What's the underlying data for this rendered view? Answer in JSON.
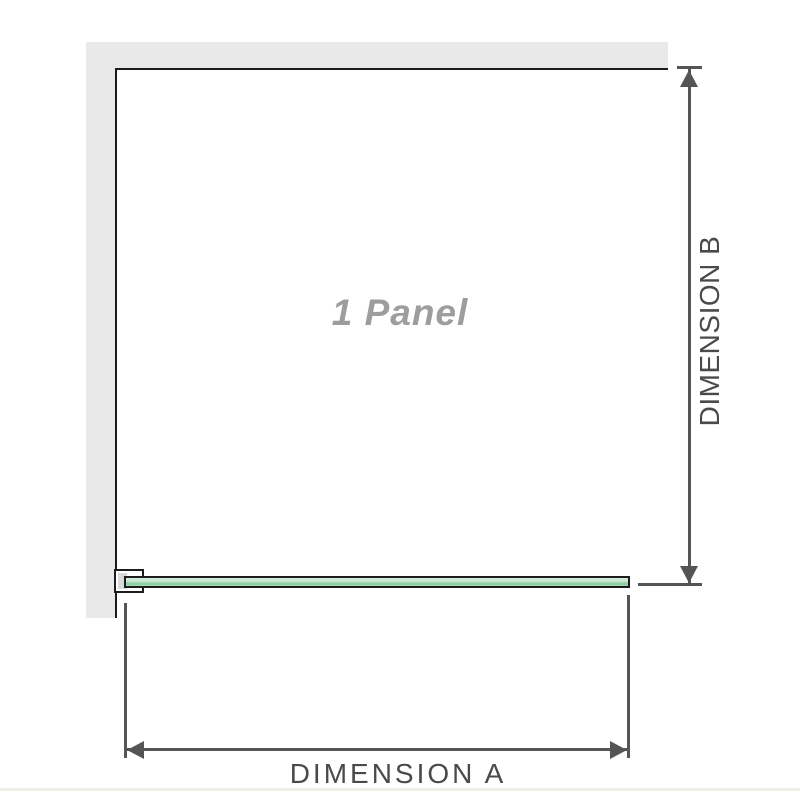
{
  "diagram": {
    "panel_label": "1 Panel",
    "dimension_a": {
      "label": "DIMENSION A"
    },
    "dimension_b": {
      "label": "DIMENSION B"
    }
  },
  "colors": {
    "background": "#ffffff",
    "wall_fill": "#e9e9e9",
    "frame_outline": "#1c1c1c",
    "dimension_line": "#555555",
    "dimension_text": "#4a4a4a",
    "panel_text": "#9d9d9d",
    "glass_light": "#c3e5ce",
    "glass_dark": "#90d1a6",
    "bracket_pad": "#d9d9d9",
    "footer_line": "#f0ece6"
  }
}
